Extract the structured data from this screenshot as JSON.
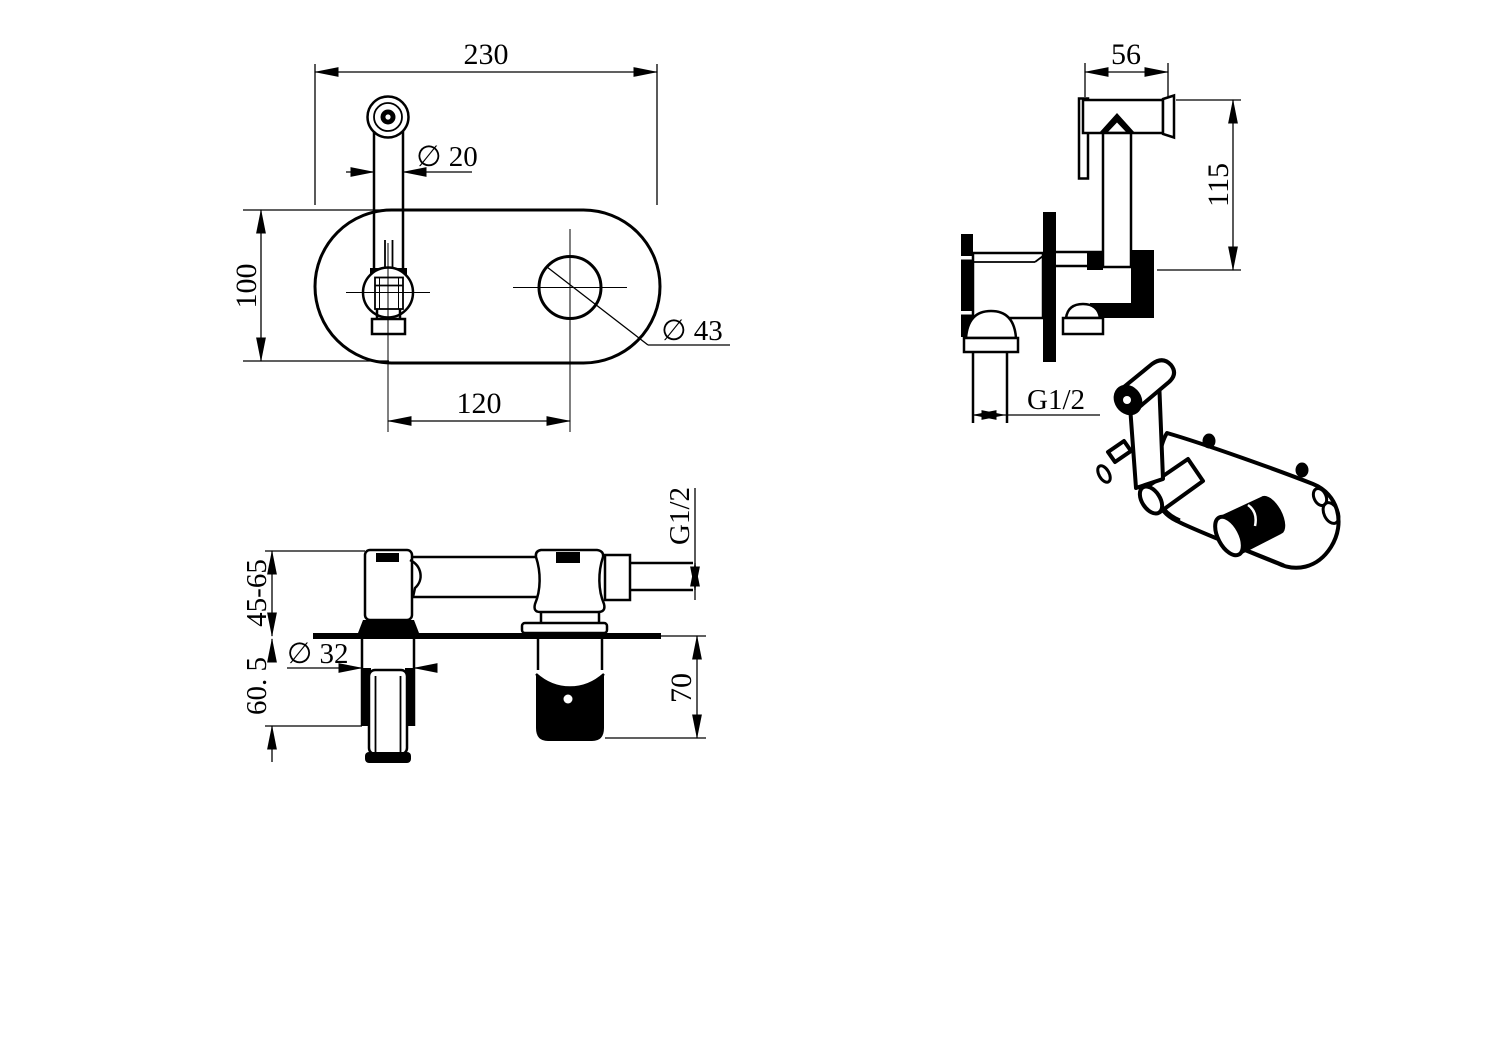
{
  "canvas": {
    "background": "#ffffff",
    "ink": "#000000"
  },
  "drawing": {
    "type": "technical-dimension-drawing",
    "subject": "wall-mounted bidet sprayer mixer, four views"
  },
  "views": {
    "front": {
      "width": "230",
      "spout_diameter": "∅ 20",
      "height": "100",
      "hole_spacing": "120",
      "handle_hole_diameter": "∅ 43"
    },
    "side": {
      "head_width": "56",
      "overall_height": "115",
      "inlet_thread": "G1/2"
    },
    "plan": {
      "mount_depth_range": "45-65",
      "escutcheon_depth": "60. 5",
      "escutcheon_diameter": "∅ 32",
      "body_depth": "70",
      "outlet_thread": "G1/2"
    }
  }
}
